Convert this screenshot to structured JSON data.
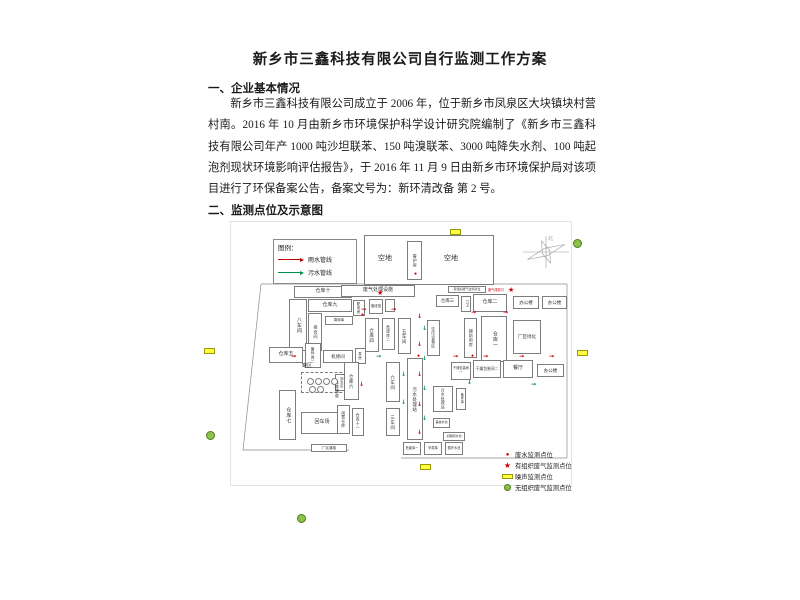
{
  "document": {
    "title": "新乡市三鑫科技有限公司自行监测工作方案",
    "section1": {
      "heading": "一、企业基本情况",
      "paragraph": "新乡市三鑫科技有限公司成立于 2006 年，位于新乡市凤泉区大块镇块村营村南。2016 年 10 月由新乡市环境保护科学设计研究院编制了《新乡市三鑫科技有限公司年产 1000 吨沙坦联苯、150 吨溴联苯、3000 吨降失水剂、100 吨起泡剂现状环境影响评估报告》，于 2016 年 11 月 9 日由新乡市环境保护局对该项目进行了环保备案公告，备案文号为：新环清改备 第 2 号。"
    },
    "section2": {
      "heading": "二、监测点位及示意图"
    }
  },
  "diagram": {
    "legend": {
      "title": "图例：",
      "items": [
        {
          "label": "雨水管线",
          "color": "#c00000"
        },
        {
          "label": "污水管线",
          "color": "#00904a"
        }
      ]
    },
    "monitor_legend": {
      "items": [
        {
          "symbol": "dot",
          "color": "#cc0000",
          "label": "废水监测点位"
        },
        {
          "symbol": "star",
          "color": "#cc0000",
          "label": "有组织废气监测点位"
        },
        {
          "symbol": "rect",
          "color": "#ffff3d",
          "label": "噪声监测点位"
        },
        {
          "symbol": "circle",
          "color": "#8bc34a",
          "label": "无组织废气监测点位"
        }
      ]
    },
    "compass_label": "北",
    "outlet_note": {
      "red_label": "废气排放口"
    },
    "buildings": [
      {
        "label": "",
        "x": 133,
        "y": 13,
        "w": 130,
        "h": 50,
        "fs": 7
      },
      {
        "label": "空地",
        "x": 138,
        "y": 30,
        "w": 32,
        "h": 14,
        "fs": 7,
        "nb": 1
      },
      {
        "label": "看护房",
        "x": 176,
        "y": 19,
        "w": 15,
        "h": 39,
        "v": 1,
        "fs": 4
      },
      {
        "label": "空地",
        "x": 204,
        "y": 30,
        "w": 32,
        "h": 14,
        "fs": 7,
        "nb": 1
      },
      {
        "label": "仓库十",
        "x": 63,
        "y": 64,
        "w": 58,
        "h": 12,
        "fs": 5
      },
      {
        "label": "仓库九",
        "x": 77,
        "y": 77,
        "w": 44,
        "h": 13,
        "fs": 5
      },
      {
        "label": "八车间",
        "x": 58,
        "y": 77,
        "w": 18,
        "h": 52,
        "v": 1,
        "fs": 5
      },
      {
        "label": "接合间",
        "x": 77,
        "y": 91,
        "w": 14,
        "h": 38,
        "v": 1,
        "fs": 4.2
      },
      {
        "label": "周转库",
        "x": 94,
        "y": 94,
        "w": 28,
        "h": 9,
        "fs": 3.5
      },
      {
        "label": "备件库二",
        "x": 74,
        "y": 121,
        "w": 16,
        "h": 25,
        "v": 1,
        "fs": 3.8
      },
      {
        "label": "仓库五",
        "x": 38,
        "y": 125,
        "w": 34,
        "h": 16,
        "fs": 5
      },
      {
        "label": "机修间",
        "x": 92,
        "y": 128,
        "w": 30,
        "h": 13,
        "fs": 4.5
      },
      {
        "label": "泵房",
        "x": 124,
        "y": 126,
        "w": 11,
        "h": 16,
        "v": 1,
        "fs": 3.5
      },
      {
        "label": "罐区",
        "x": 66,
        "y": 140,
        "w": 20,
        "h": 9,
        "fs": 5,
        "nb": 1
      },
      {
        "label": "",
        "x": 70,
        "y": 150,
        "w": 46,
        "h": 21,
        "fs": 4,
        "dash": 1
      },
      {
        "label": "卸车区",
        "x": 104,
        "y": 152,
        "w": 11,
        "h": 17,
        "v": 1,
        "fs": 3.2
      },
      {
        "label": "仓库七",
        "x": 48,
        "y": 168,
        "w": 17,
        "h": 50,
        "v": 1,
        "fs": 5
      },
      {
        "label": "回车场",
        "x": 70,
        "y": 190,
        "w": 42,
        "h": 22,
        "fs": 5
      },
      {
        "label": "厂区道路",
        "x": 80,
        "y": 222,
        "w": 36,
        "h": 8,
        "fs": 3.5
      },
      {
        "label": "运输通道",
        "x": 100,
        "y": 138,
        "w": 11,
        "h": 58,
        "v": 1,
        "fs": 4,
        "nb": 1
      },
      {
        "label": "仓库六",
        "x": 113,
        "y": 140,
        "w": 15,
        "h": 38,
        "v": 1,
        "fs": 4.5
      },
      {
        "label": "闲置仓库",
        "x": 106,
        "y": 183,
        "w": 13,
        "h": 29,
        "v": 1,
        "fs": 3.8
      },
      {
        "label": "仓库十一",
        "x": 121,
        "y": 186,
        "w": 12,
        "h": 28,
        "v": 1,
        "fs": 3.8
      },
      {
        "label": "废气处理设施",
        "x": 110,
        "y": 63,
        "w": 74,
        "h": 12,
        "fs": 5
      },
      {
        "label": "配电房",
        "x": 122,
        "y": 78,
        "w": 12,
        "h": 16,
        "v": 1,
        "fs": 3.5
      },
      {
        "label": "值班室",
        "x": 138,
        "y": 77,
        "w": 14,
        "h": 15,
        "fs": 3.5
      },
      {
        "label": "",
        "x": 154,
        "y": 77,
        "w": 10,
        "h": 13,
        "fs": 3.5
      },
      {
        "label": "仓库四",
        "x": 134,
        "y": 96,
        "w": 14,
        "h": 34,
        "v": 1,
        "fs": 4.5
      },
      {
        "label": "危废库二",
        "x": 151,
        "y": 96,
        "w": 13,
        "h": 32,
        "v": 1,
        "fs": 3.8
      },
      {
        "label": "五车间",
        "x": 167,
        "y": 96,
        "w": 13,
        "h": 36,
        "v": 1,
        "fs": 4.5
      },
      {
        "label": "六车间",
        "x": 155,
        "y": 140,
        "w": 14,
        "h": 40,
        "v": 1,
        "fs": 4.5
      },
      {
        "label": "三车间",
        "x": 155,
        "y": 186,
        "w": 14,
        "h": 28,
        "v": 1,
        "fs": 4.5
      },
      {
        "label": "污水处理站",
        "x": 176,
        "y": 136,
        "w": 16,
        "h": 82,
        "v": 1,
        "fs": 4.5
      },
      {
        "label": "仓库三",
        "x": 205,
        "y": 73,
        "w": 23,
        "h": 12,
        "fs": 4.5
      },
      {
        "label": "门卫",
        "x": 230,
        "y": 74,
        "w": 10,
        "h": 16,
        "v": 1,
        "fs": 3.2
      },
      {
        "label": "仓库二",
        "x": 242,
        "y": 72,
        "w": 34,
        "h": 18,
        "fs": 5
      },
      {
        "label": "办公楼",
        "x": 282,
        "y": 74,
        "w": 26,
        "h": 13,
        "fs": 4.5
      },
      {
        "label": "办公楼",
        "x": 311,
        "y": 74,
        "w": 25,
        "h": 13,
        "fs": 4.5
      },
      {
        "label": "有组织废气监测点位",
        "x": 217,
        "y": 64,
        "w": 38,
        "h": 7,
        "fs": 3
      },
      {
        "label": "空压设备区",
        "x": 196,
        "y": 98,
        "w": 13,
        "h": 36,
        "v": 1,
        "fs": 3.8
      },
      {
        "label": "辅助用房",
        "x": 233,
        "y": 96,
        "w": 13,
        "h": 40,
        "v": 1,
        "fs": 4
      },
      {
        "label": "仓库一",
        "x": 250,
        "y": 94,
        "w": 26,
        "h": 46,
        "v": 1,
        "fs": 5
      },
      {
        "label": "厂区绿化",
        "x": 282,
        "y": 98,
        "w": 28,
        "h": 34,
        "fs": 4.5
      },
      {
        "label": "干燥包装间一",
        "x": 220,
        "y": 140,
        "w": 20,
        "h": 18,
        "fs": 3.2
      },
      {
        "label": "干燥包装间二",
        "x": 242,
        "y": 138,
        "w": 28,
        "h": 18,
        "fs": 3.8
      },
      {
        "label": "餐厅",
        "x": 272,
        "y": 138,
        "w": 30,
        "h": 18,
        "fs": 5
      },
      {
        "label": "办公楼",
        "x": 306,
        "y": 142,
        "w": 27,
        "h": 13,
        "fs": 4.5
      },
      {
        "label": "污水处理站",
        "x": 202,
        "y": 164,
        "w": 20,
        "h": 26,
        "v": 1,
        "fs": 3.8
      },
      {
        "label": "备件库",
        "x": 225,
        "y": 166,
        "w": 10,
        "h": 22,
        "v": 1,
        "fs": 3.2
      },
      {
        "label": "事故水池",
        "x": 202,
        "y": 196,
        "w": 17,
        "h": 10,
        "fs": 3
      },
      {
        "label": "初期雨水池",
        "x": 212,
        "y": 210,
        "w": 22,
        "h": 9,
        "fs": 3
      },
      {
        "label": "危废库一",
        "x": 172,
        "y": 220,
        "w": 18,
        "h": 13,
        "fs": 3.2
      },
      {
        "label": "甲类库",
        "x": 193,
        "y": 220,
        "w": 18,
        "h": 13,
        "fs": 3.2
      },
      {
        "label": "循环水池",
        "x": 214,
        "y": 220,
        "w": 18,
        "h": 13,
        "fs": 3.2
      }
    ],
    "tanks": [
      [
        76,
        156
      ],
      [
        84,
        156
      ],
      [
        92,
        156
      ],
      [
        100,
        156
      ],
      [
        78,
        164
      ],
      [
        86,
        164
      ]
    ],
    "pipes": [
      {
        "x": 130,
        "y": 85,
        "d": "r",
        "c": "r"
      },
      {
        "x": 160,
        "y": 85,
        "d": "r",
        "c": "r"
      },
      {
        "x": 240,
        "y": 88,
        "d": "r",
        "c": "r"
      },
      {
        "x": 272,
        "y": 88,
        "d": "r",
        "c": "r"
      },
      {
        "x": 186,
        "y": 92,
        "d": "d",
        "c": "r"
      },
      {
        "x": 186,
        "y": 120,
        "d": "d",
        "c": "r"
      },
      {
        "x": 186,
        "y": 150,
        "d": "d",
        "c": "r"
      },
      {
        "x": 186,
        "y": 180,
        "d": "d",
        "c": "r"
      },
      {
        "x": 186,
        "y": 208,
        "d": "d",
        "c": "r"
      },
      {
        "x": 222,
        "y": 132,
        "d": "r",
        "c": "r"
      },
      {
        "x": 252,
        "y": 132,
        "d": "r",
        "c": "r"
      },
      {
        "x": 288,
        "y": 132,
        "d": "r",
        "c": "r"
      },
      {
        "x": 318,
        "y": 132,
        "d": "r",
        "c": "r"
      },
      {
        "x": 60,
        "y": 132,
        "d": "r",
        "c": "r"
      },
      {
        "x": 128,
        "y": 160,
        "d": "d",
        "c": "r"
      },
      {
        "x": 191,
        "y": 104,
        "d": "d",
        "c": "g"
      },
      {
        "x": 191,
        "y": 134,
        "d": "d",
        "c": "g"
      },
      {
        "x": 191,
        "y": 164,
        "d": "d",
        "c": "g"
      },
      {
        "x": 191,
        "y": 194,
        "d": "d",
        "c": "g"
      },
      {
        "x": 170,
        "y": 150,
        "d": "d",
        "c": "g"
      },
      {
        "x": 170,
        "y": 178,
        "d": "d",
        "c": "g"
      },
      {
        "x": 236,
        "y": 158,
        "d": "d",
        "c": "g"
      },
      {
        "x": 145,
        "y": 132,
        "d": "r",
        "c": "g"
      },
      {
        "x": 300,
        "y": 160,
        "d": "r",
        "c": "g"
      }
    ],
    "stars": [
      [
        146,
        68
      ],
      [
        277,
        65
      ]
    ],
    "red_dots": [
      [
        186,
        132
      ],
      [
        240,
        132
      ],
      [
        130,
        91
      ],
      [
        183,
        50
      ]
    ],
    "noise_points": [
      [
        450,
        229
      ],
      [
        204,
        348
      ],
      [
        577,
        350
      ],
      [
        420,
        464
      ]
    ],
    "gas_points": [
      [
        573,
        239
      ],
      [
        206,
        431
      ],
      [
        297,
        514
      ]
    ]
  }
}
